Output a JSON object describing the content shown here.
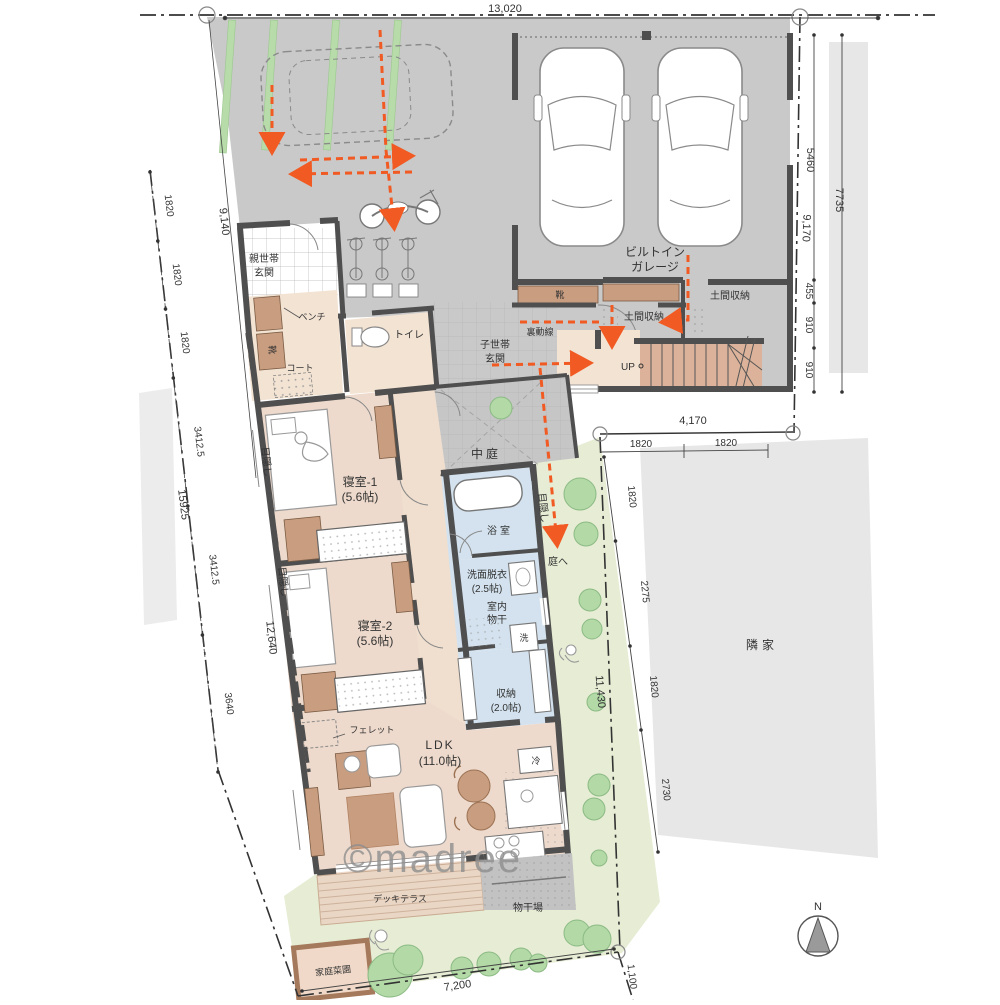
{
  "meta": {
    "type": "floor-plan",
    "watermark": "©madree",
    "compass_label": "N",
    "colors": {
      "wall": "#4f4f4f",
      "driveway_gray": "#c9c9c9",
      "floor_beige": "#eedacc",
      "hall_beige": "#f3e3d3",
      "wet_blue": "#d3e2ee",
      "garden_green": "#e6edd4",
      "tree_green": "#b2d9a6",
      "grass_strip": "#b7dcaa",
      "furniture_brown": "#c99d80",
      "stair_brown": "#dcb39a",
      "deck_wood": "#ead6c5",
      "flow_orange": "#f15a22",
      "neighbor_gray": "#e7e7e7"
    }
  },
  "dims": {
    "top": "13,020",
    "r5460": "5460",
    "r455": "455",
    "r910a": "910",
    "r910b": "910",
    "r7735": "7735",
    "r9170": "9,170",
    "m4170": "4,170",
    "m1820a": "1820",
    "m1820b": "1820",
    "e1820a": "1820",
    "e2275": "2275",
    "e1820b": "1820",
    "e2730": "2730",
    "e11430": "11,430",
    "w1820a": "1820",
    "w1820b": "1820",
    "w1820c": "1820",
    "w34125a": "3412.5",
    "w34125b": "3412.5",
    "w3640": "3640",
    "w15925": "15925",
    "w9140": "9,140",
    "w12640": "12,640",
    "b7200": "7,200",
    "b1100": "1,100"
  },
  "labels": {
    "oyasetai1": "親世帯",
    "oyasetai2": "玄関",
    "bench": "ベンチ",
    "kutsu_oya": "靴",
    "coat": "コート",
    "toilet": "トイレ",
    "kosetai1": "子世帯",
    "kosetai2": "玄関",
    "uradousen": "裏動線",
    "kutsu_ko": "靴",
    "doma1": "土間収納",
    "doma2": "土間収納",
    "garage1": "ビルトイン",
    "garage2": "ガレージ",
    "up": "UP",
    "nakaniwa": "中庭",
    "bed1a": "寝室-1",
    "bed1b": "(5.6帖)",
    "bed2a": "寝室-2",
    "bed2b": "(5.6帖)",
    "mekakushi1": "目隠し",
    "mekakushi2": "目隠し",
    "mekakushi3": "目隠し",
    "bath": "浴室",
    "senmen1": "洗面脱衣",
    "senmen2": "(2.5帖)",
    "monohoshi1": "室内",
    "monohoshi2": "物干",
    "washer": "洗",
    "shuno1": "収納",
    "shuno2": "(2.0帖)",
    "ldk1": "LDK",
    "ldk2": "(11.0帖)",
    "fridge": "冷",
    "ferret": "フェレット",
    "niwae": "庭へ",
    "deck": "デッキテラス",
    "monohoshiba": "物干場",
    "saien": "家庭菜園",
    "rinka": "隣家"
  }
}
